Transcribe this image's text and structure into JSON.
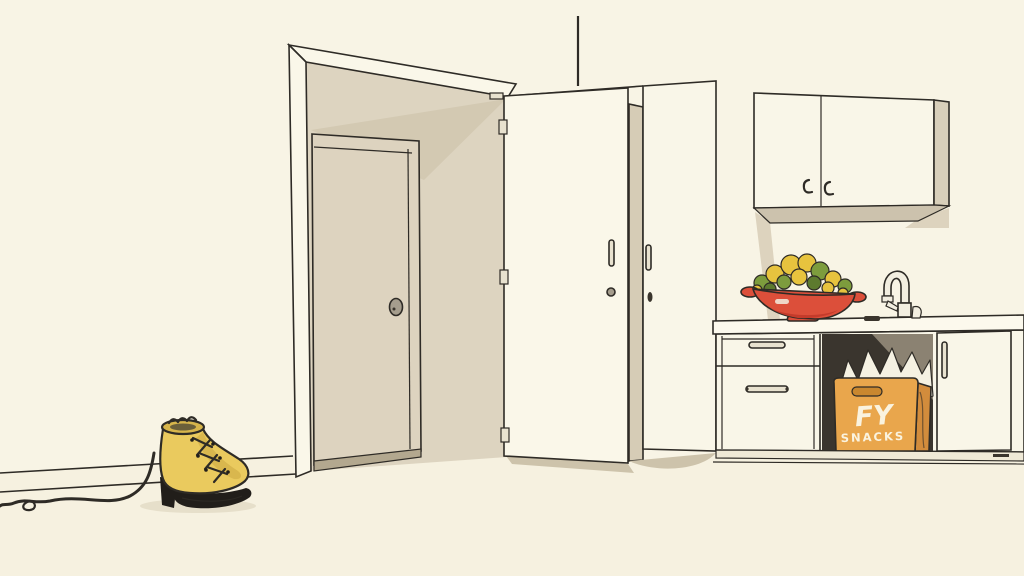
{
  "box": {
    "logo": "FY",
    "label": "SNACKS"
  },
  "objects": [
    "doorway",
    "inner-door",
    "open-door",
    "tall-cabinet",
    "upper-cabinets",
    "kitchen-counter",
    "drawer-unit",
    "open-cavity",
    "paper-bags",
    "snack-box",
    "cabinet-door",
    "fruit-bowl",
    "faucet",
    "yellow-boot",
    "cord"
  ],
  "colors": {
    "wall": "#f8f4e5",
    "floor": "#f6f1e0",
    "line": "#2e2b26",
    "door_frame": "#faf7e9",
    "door_reveal": "#ddd4c0",
    "reveal_shadow": "#d3c9b2",
    "inner_door": "#ddd3bf",
    "threshold": "#b3a88f",
    "knob": "#a59d8d",
    "open_door": "#faf7e9",
    "hinge": "#e8e2cf",
    "floor_shadow": "#cdc3ab",
    "cab_side": "#d6ccb6",
    "cab_front": "#f9f6e8",
    "upper_front": "#f9f6e8",
    "upper_side": "#d8cfba",
    "upper_underside": "#ccc2ad",
    "wall_shadow": "#ddd3be",
    "counter": "#fcf9ed",
    "base": "#f9f6e8",
    "kick": "#efe9d6",
    "cavity": "#3a352e",
    "cavity_light": "#8b8272",
    "bags": "#f5f1e2",
    "box_front": "#e9a64c",
    "box_side": "#d28c3c",
    "box_slot": "#c9872f",
    "box_text": "#faf3df",
    "bowl": "#dc4f3a",
    "bowl_dark": "#c43b2b",
    "bowl_highlight": "#f2ede0",
    "fruit_yellow": "#e7c33e",
    "fruit_green": "#7d9c3d",
    "fruit_dark_green": "#5d7a2e",
    "faucet": "#f2eee0",
    "dark_item": "#3a352d",
    "boot": "#eaca5e",
    "boot_shade": "#d4b24a",
    "boot_dark": "#211e1a",
    "boot_collar": "#d7b54b",
    "boot_inner": "#6b5f3a",
    "boot_shadow": "#e6dfca"
  }
}
